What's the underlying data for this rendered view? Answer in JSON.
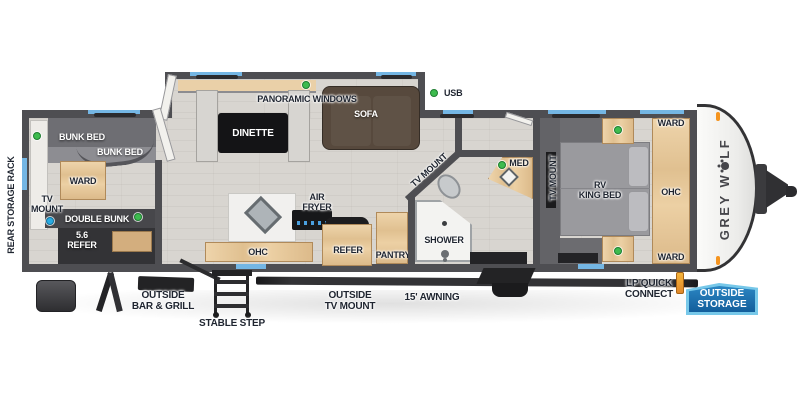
{
  "colors": {
    "wall": "#4e4e52",
    "floor": "#d8d5d0",
    "window_blue": "#74b6e4",
    "indicator_green": "#3dbb4e",
    "indicator_cyan": "#29abe2",
    "wood": "#e6c89c",
    "badge_blue": "#135e9b",
    "marker_orange": "#f5941e"
  },
  "brand": {
    "logo_before_paw": "GREY W",
    "logo_after_paw": "LF",
    "full_name": "GREY WOLF"
  },
  "exterior": {
    "rear_storage_rack": "REAR STORAGE RACK",
    "bar_grill_1": "OUTSIDE",
    "bar_grill_2": "BAR & GRILL",
    "stable_step": "STABLE STEP",
    "tv_mount_1": "OUTSIDE",
    "tv_mount_2": "TV MOUNT",
    "awning": "15' AWNING",
    "lp_1": "LP QUICK",
    "lp_2": "CONNECT",
    "storage_1": "OUTSIDE",
    "storage_2": "STORAGE",
    "usb": "USB"
  },
  "bunk_room": {
    "bunk_bed_upper": "BUNK BED",
    "bunk_bed_lower": "BUNK BED",
    "ward": "WARD",
    "tv_1": "TV",
    "tv_2": "MOUNT",
    "double_bunk": "DOUBLE BUNK",
    "refer_1": "5.6",
    "refer_2": "REFER"
  },
  "living": {
    "panoramic_windows": "PANORAMIC WINDOWS",
    "dinette": "DINETTE",
    "sofa": "SOFA"
  },
  "kitchen": {
    "air_1": "AIR",
    "air_2": "FRYER",
    "ohc": "OHC",
    "refer": "REFER",
    "pantry": "PANTRY"
  },
  "bathroom": {
    "tv_mount": "TV MOUNT",
    "med": "MED",
    "shower": "SHOWER"
  },
  "bedroom": {
    "tv_mount": "TV MOUNT",
    "bed_1": "RV",
    "bed_2": "KING BED",
    "ward_top": "WARD",
    "ohc": "OHC",
    "ward_bottom": "WARD"
  }
}
